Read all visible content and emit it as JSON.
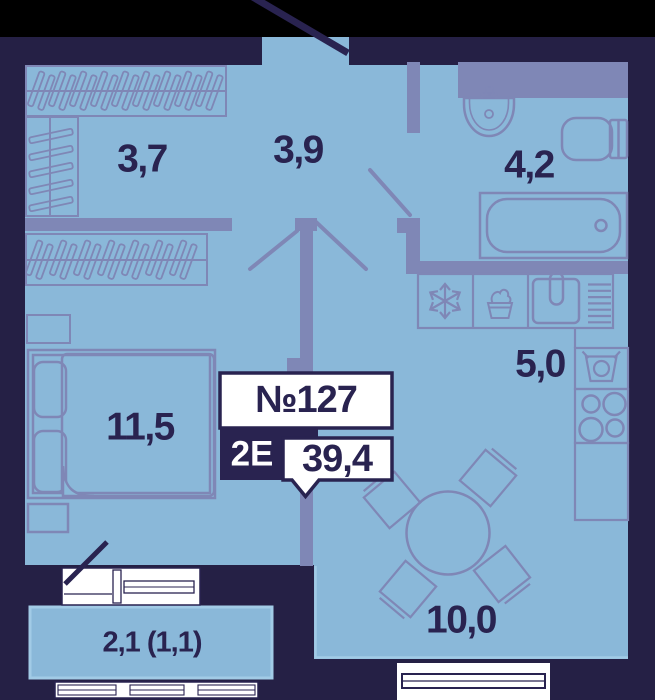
{
  "plan": {
    "unit": {
      "number": "№127",
      "type": "2Е",
      "total_area": "39,4"
    },
    "rooms": [
      {
        "name": "wardrobe",
        "area": "3,7"
      },
      {
        "name": "hall",
        "area": "3,9"
      },
      {
        "name": "bathroom",
        "area": "4,2"
      },
      {
        "name": "kitchen",
        "area": "5,0"
      },
      {
        "name": "bedroom",
        "area": "11,5"
      },
      {
        "name": "living-dining",
        "area": "10,0"
      },
      {
        "name": "balcony",
        "area": "2,1 (1,1)"
      }
    ],
    "icons": [
      "snowflake-fridge-icon",
      "dough-pot-icon",
      "kitchen-sink-icon",
      "washer-icon",
      "stove-burners-icon",
      "washbasin-icon",
      "toilet-icon",
      "bathtub-icon",
      "double-bed-icon",
      "nightstand-icon",
      "dining-table-icon",
      "chair-icon",
      "hanger-rail-icon",
      "shelf-slats-icon",
      "door-swing-icon",
      "entrance-door-swing-icon",
      "balcony-door-swing-icon",
      "window-icon"
    ],
    "colors": {
      "outside_top_strip": "#000000",
      "background_walls": "#252045",
      "room_fill": "#8AB8D9",
      "interior_walls_furniture": "#7F87B6",
      "text_and_borders": "#292350",
      "white": "#FFFFFF",
      "balcony_outline": "#A2CBE6"
    }
  }
}
